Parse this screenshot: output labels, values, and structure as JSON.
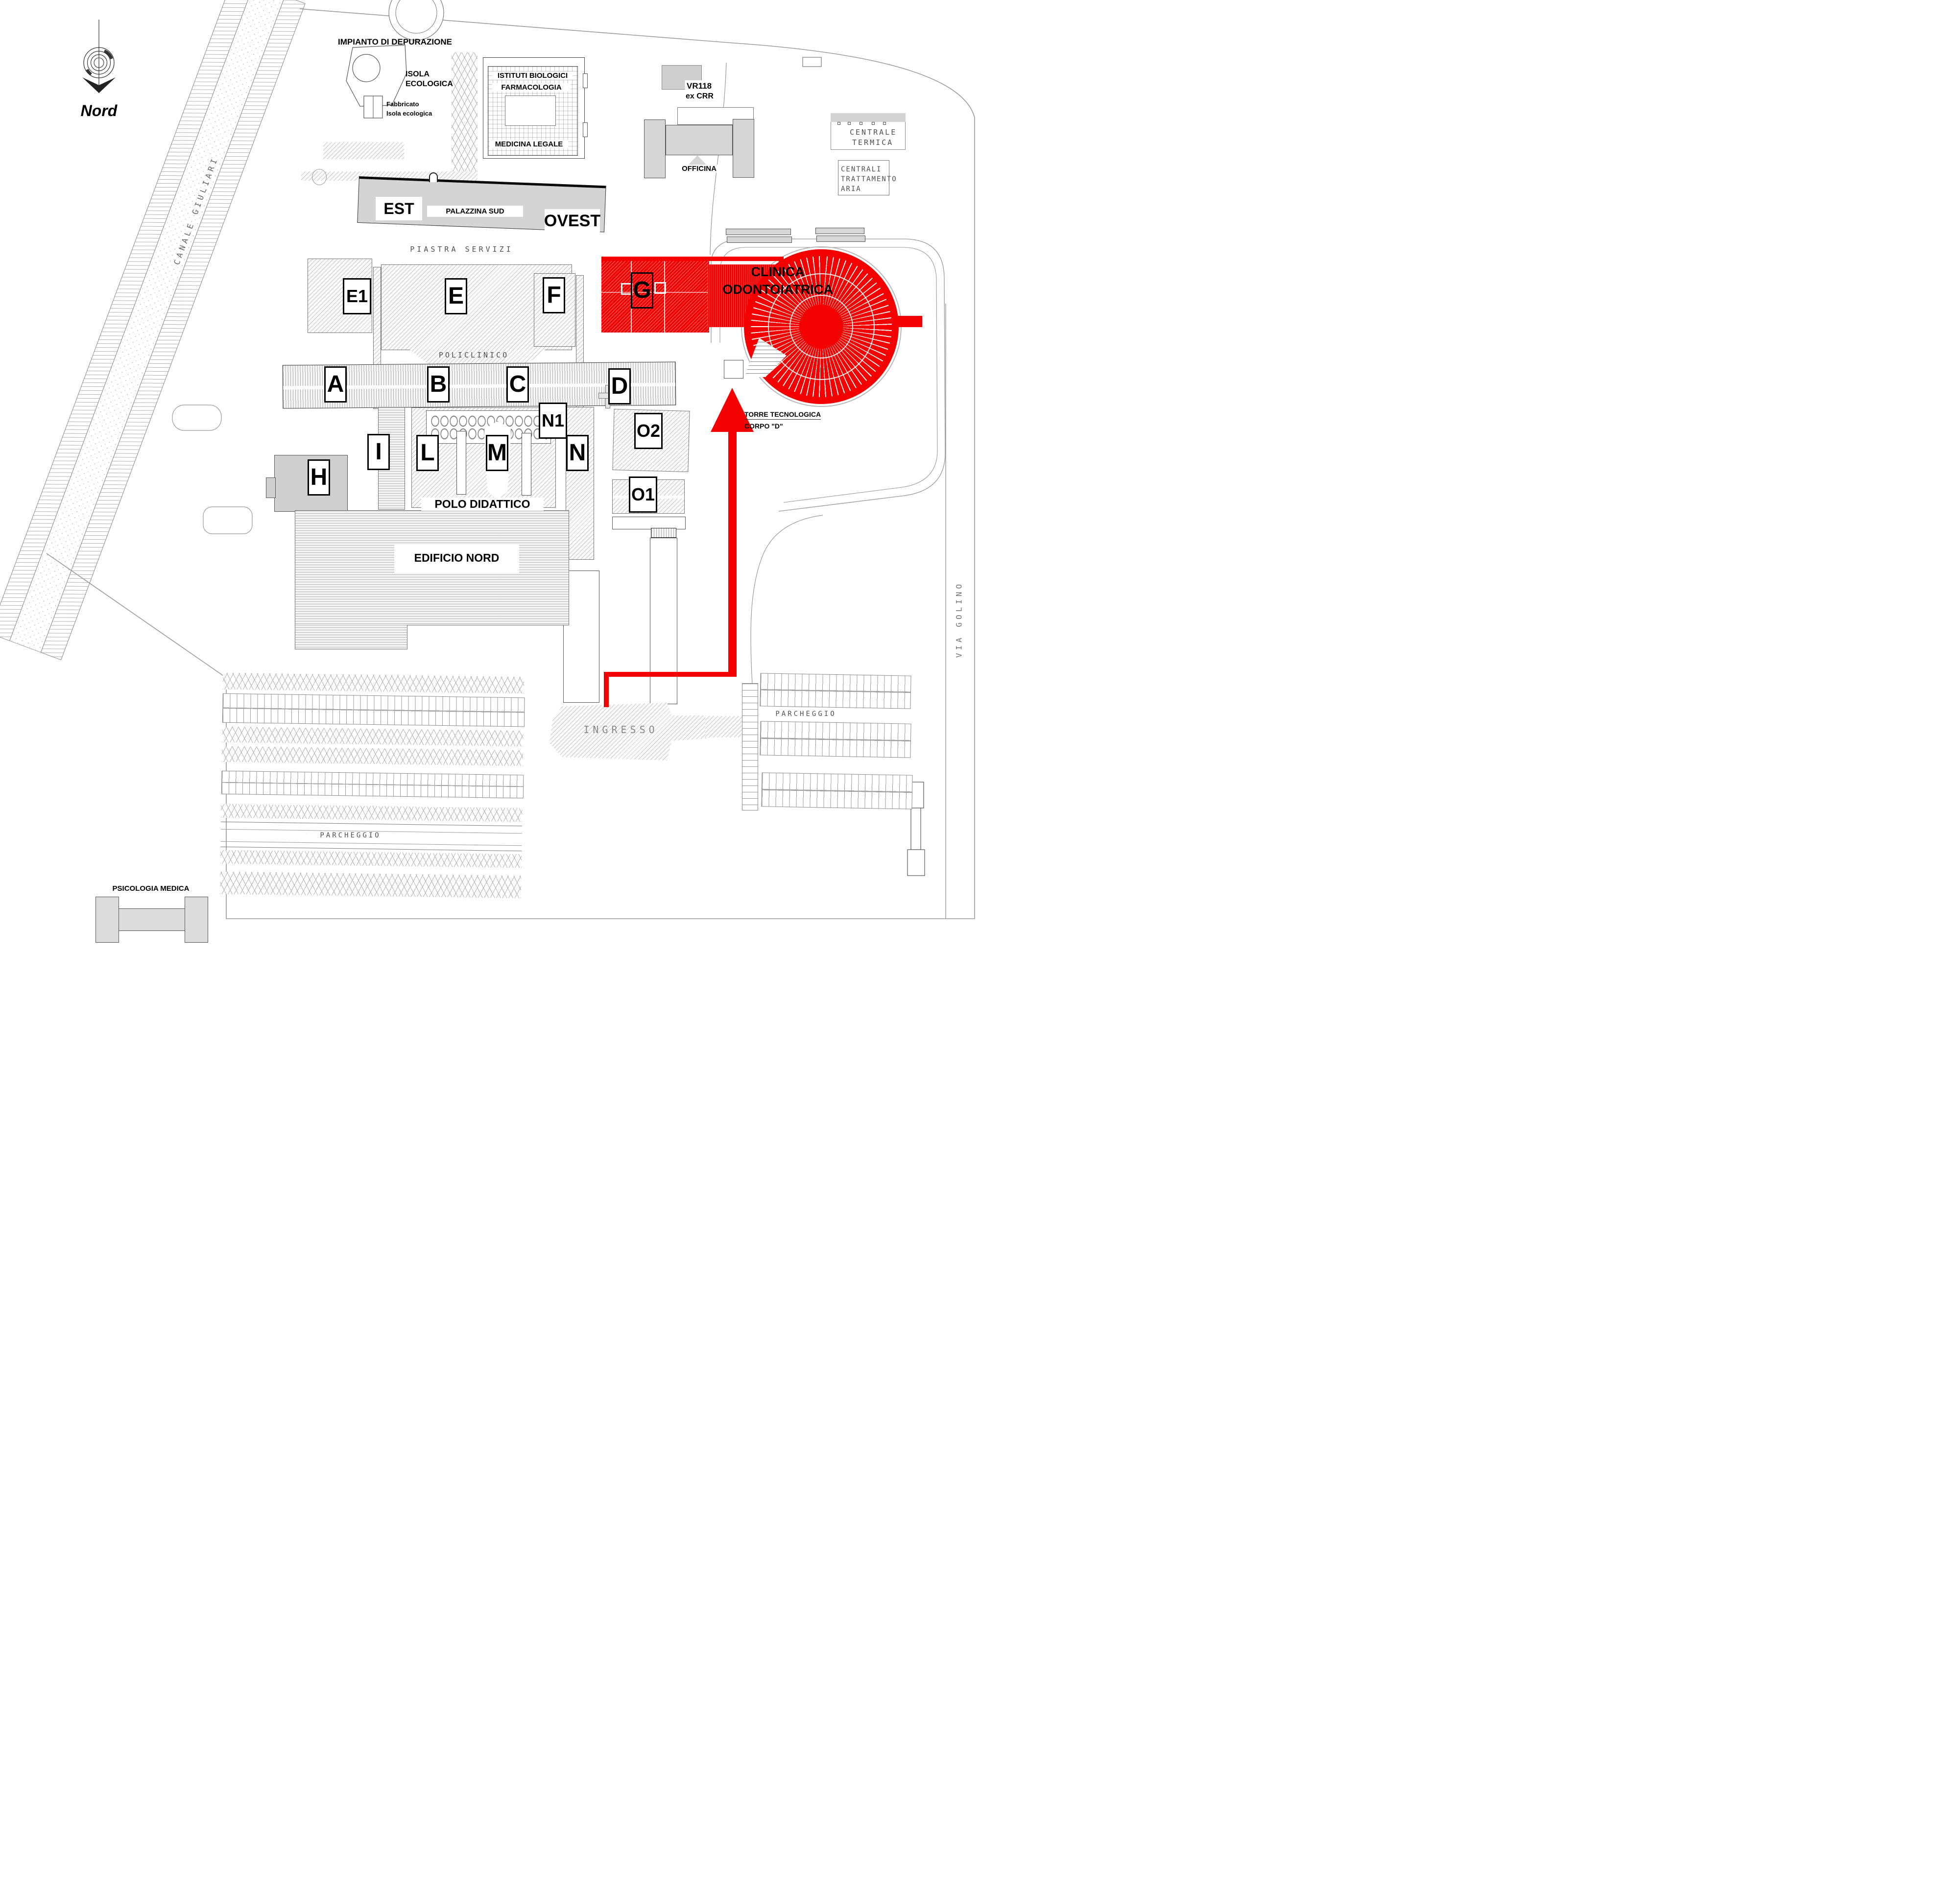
{
  "colors": {
    "highlight": "#f40000"
  },
  "compass": {
    "label": "Nord"
  },
  "waterway": {
    "label": "CANALE GIULIARI"
  },
  "street": {
    "label": "VIA GOLINO"
  },
  "north": {
    "impianto": "IMPIANTO DI DEPURAZIONE",
    "isola1": "ISOLA",
    "isola2": "ECOLOGICA",
    "fabbricato1": "Fabbricato",
    "fabbricato2": "Isola ecologica",
    "istituti1": "ISTITUTI BIOLOGICI",
    "istituti2": "FARMACOLOGIA",
    "medicina": "MEDICINA LEGALE",
    "vr1": "VR118",
    "vr2": "ex CRR",
    "officina": "OFFICINA",
    "centrale1": "CENTRALE",
    "centrale2": "TERMICA",
    "centrali1": "CENTRALI",
    "centrali2": "TRATTAMENTO",
    "centrali3": "ARIA"
  },
  "palazzina": {
    "est": "EST",
    "name": "PALAZZINA SUD",
    "ovest": "OVEST"
  },
  "areas": {
    "piastra": "PIASTRA SERVIZI",
    "policlinico": "POLICLINICO",
    "polo": "POLO DIDATTICO",
    "edificio": "EDIFICIO NORD",
    "ingresso": "INGRESSO",
    "parcheggio_est": "PARCHEGGIO",
    "parcheggio_sud": "PARCHEGGIO",
    "psicologia": "PSICOLOGIA MEDICA"
  },
  "clinica": {
    "line1": "CLINICA",
    "line2": "ODONTOIATRICA"
  },
  "torre": {
    "line1": "TORRE TECNOLOGICA",
    "line2": "CORPO \"D\""
  },
  "badges": [
    {
      "label": "E1"
    },
    {
      "label": "E"
    },
    {
      "label": "F"
    },
    {
      "label": "G"
    },
    {
      "label": "A"
    },
    {
      "label": "B"
    },
    {
      "label": "C"
    },
    {
      "label": "D"
    },
    {
      "label": "N1"
    },
    {
      "label": "I"
    },
    {
      "label": "L"
    },
    {
      "label": "M"
    },
    {
      "label": "N"
    },
    {
      "label": "O2"
    },
    {
      "label": "O1"
    },
    {
      "label": "H"
    }
  ]
}
